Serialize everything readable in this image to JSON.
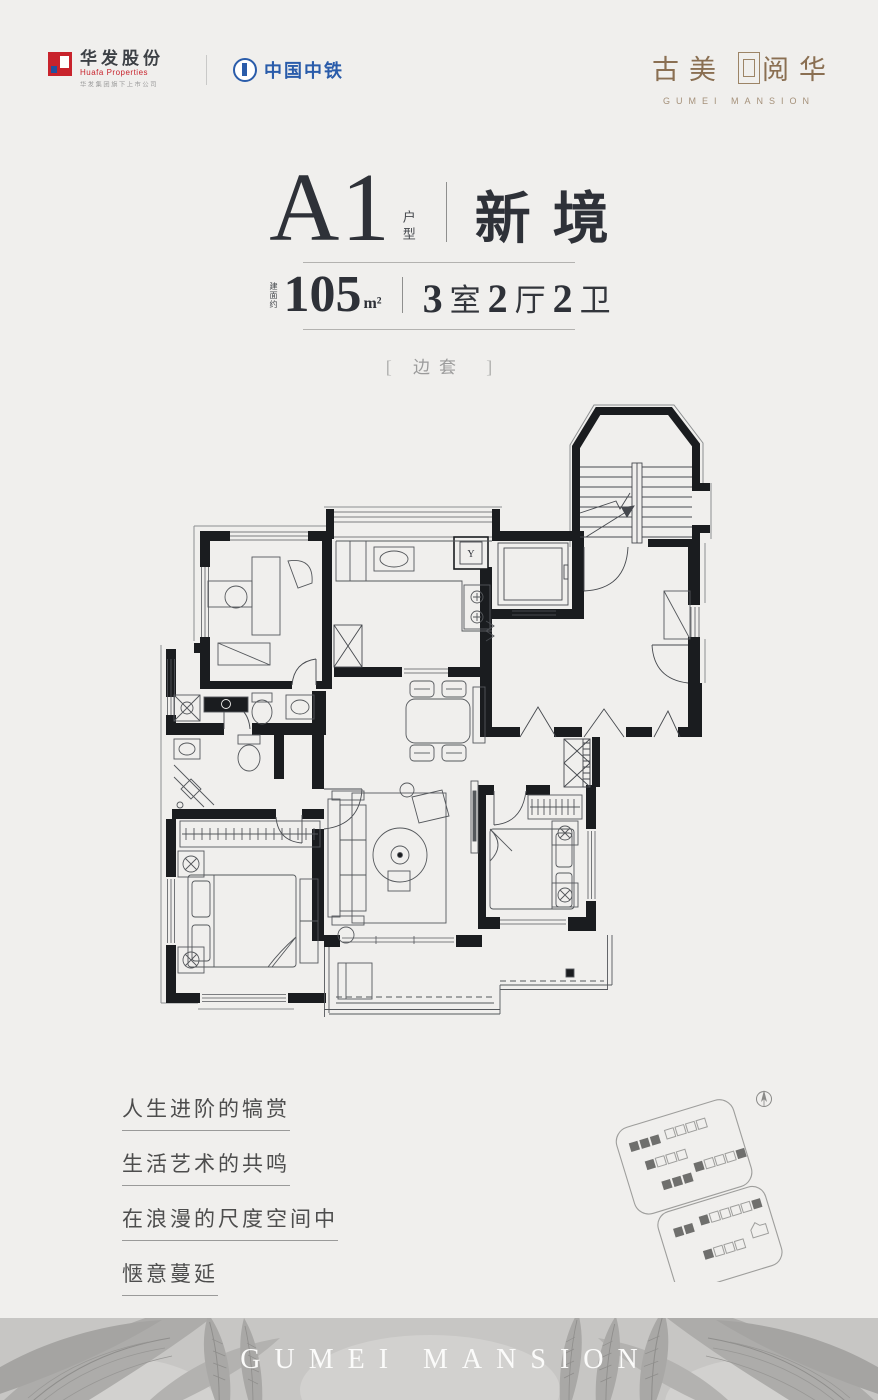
{
  "header": {
    "huafa": {
      "name": "华发股份",
      "sub": "Huafa Properties",
      "tagline": "华发集团旗下上市公司"
    },
    "crec": {
      "name": "中国中铁"
    },
    "brand": {
      "cn_left": "古美",
      "cn_right": "阅华",
      "en": "GUMEI MANSION"
    }
  },
  "title": {
    "unit": "A1",
    "unit_suffix": "户型",
    "name": "新境",
    "area_prefix": "建面约",
    "area_value": "105",
    "area_unit": "m²",
    "layout": [
      {
        "num": "3",
        "label": "室"
      },
      {
        "num": "2",
        "label": "厅"
      },
      {
        "num": "2",
        "label": "卫"
      }
    ],
    "tag_open": "[",
    "tag": "边套",
    "tag_close": "]"
  },
  "floorplan": {
    "meter_label": "Y"
  },
  "poem": {
    "lines": [
      "人生进阶的犒赏",
      "生活艺术的共鸣",
      "在浪漫的尺度空间中",
      "惬意蔓延"
    ]
  },
  "footer": {
    "wordmark": "GUMEI MANSION"
  },
  "colors": {
    "accent_red": "#c8232c",
    "accent_blue": "#2a5caa",
    "brand_brown": "#8a6f52",
    "band_gray": "#c7c6c4",
    "wall_black": "#1a1c1f"
  }
}
